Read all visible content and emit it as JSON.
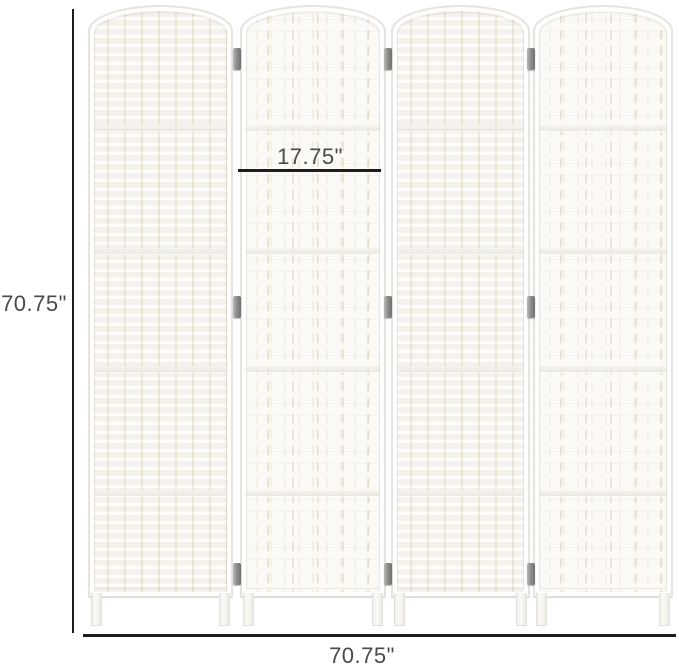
{
  "figure": {
    "panel_count": 4
  },
  "dimensions": {
    "height_label": "70.75\"",
    "width_label": "70.75\"",
    "panel_width_label": "17.75\""
  },
  "colors": {
    "background": "#ffffff",
    "dimension-line": "#1d1d1d",
    "dimension-text": "#4a4a4a",
    "panel-base": "#fbfaf7",
    "panel-border": "#e6e4df",
    "weave-gap": "#e9ddc6",
    "hinge": "#8f8f8d"
  }
}
